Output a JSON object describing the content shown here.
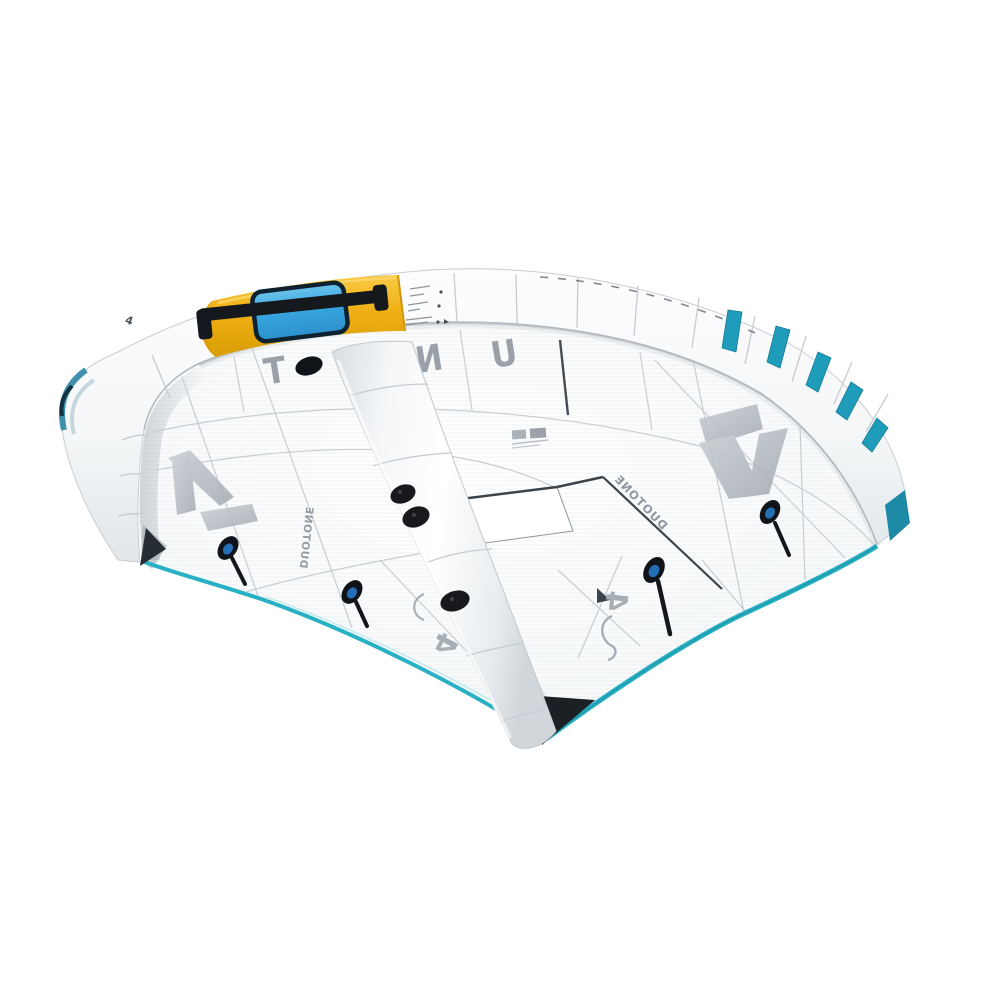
{
  "image": {
    "alt": "Product photo of a white inflatable wing foil wing with yellow handle segment, blue valve window, teal stripes and grey DUOTONE branding on a white background",
    "background": "#ffffff"
  },
  "branding": {
    "model_word": "UNIT",
    "letter_t": "T",
    "letter_n": "N",
    "letter_u": "U",
    "brand_name": "DUOTONE",
    "brand_left": "DUOTONE",
    "brand_right": "DUOTONE",
    "size_label_left": "4",
    "size_label_right": "4",
    "size_label_leading_edge": "4"
  },
  "colors": {
    "accent_yellow": "#f0b014",
    "accent_teal": "#1f9cba",
    "trailing_edge_teal": "#28b0c4",
    "window_blue": "#3aa8e2",
    "hardware_black": "#15191d",
    "logo_grey": "#b3bac0",
    "letter_grey": "#99a0a7",
    "canopy_white": "#fbfcfd"
  }
}
